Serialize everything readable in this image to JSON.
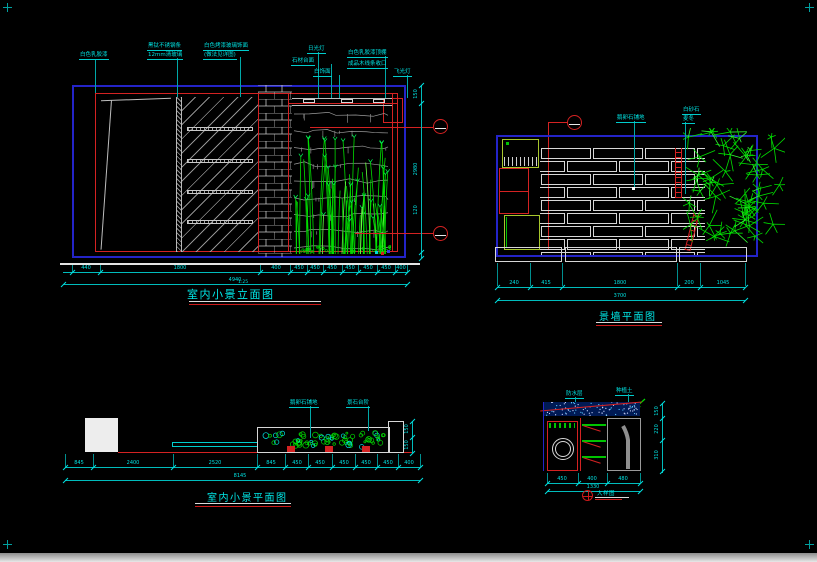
{
  "colors": {
    "background": "#000000",
    "annotation_cyan": "#00e0e0",
    "frame_blue": "#2424c8",
    "line_red": "#d42222",
    "plant_green": "#00dd00",
    "hatch_gray": "#c4c4c4"
  },
  "views": {
    "elevation": {
      "title": "室内小景立面图",
      "scale_note": "1:25",
      "callouts": [
        "白色乳胶漆",
        "黑钛不锈钢条",
        "12mm清玻璃",
        "白色烤漆玻璃饰面",
        "(做法见详图)",
        "日光灯",
        "石材台面",
        "白饰面",
        "白色乳胶漆顶棚",
        "成品木线条收口",
        "飞光灯"
      ],
      "dims": {
        "segments": [
          "440",
          "1800",
          "400",
          "450",
          "450",
          "450",
          "450",
          "450",
          "450",
          "400"
        ],
        "total": "4940",
        "right": [
          "150",
          "2980",
          "120"
        ]
      }
    },
    "plan_wall": {
      "title": "景墙平面图",
      "callouts": [
        "鹅卵石铺地",
        "白砂石",
        "麦冬"
      ],
      "dims": {
        "segments": [
          "240",
          "415",
          "1800",
          "200",
          "1045"
        ],
        "total": "3700"
      }
    },
    "plan_interior": {
      "title": "室内小景平面图",
      "callouts": [
        "鹅卵石铺地",
        "景石台阶"
      ],
      "dims": {
        "segments": [
          "845",
          "2400",
          "2520",
          "845",
          "450",
          "450",
          "450",
          "450",
          "450",
          "400"
        ],
        "total": "8145",
        "right": [
          "150",
          "150"
        ]
      }
    },
    "detail": {
      "title": "大样图",
      "callouts": [
        "防水层",
        "种植土"
      ],
      "dims": {
        "segments": [
          "450",
          "400",
          "480"
        ],
        "total": "1330",
        "right": [
          "150",
          "220",
          "310"
        ]
      }
    }
  }
}
